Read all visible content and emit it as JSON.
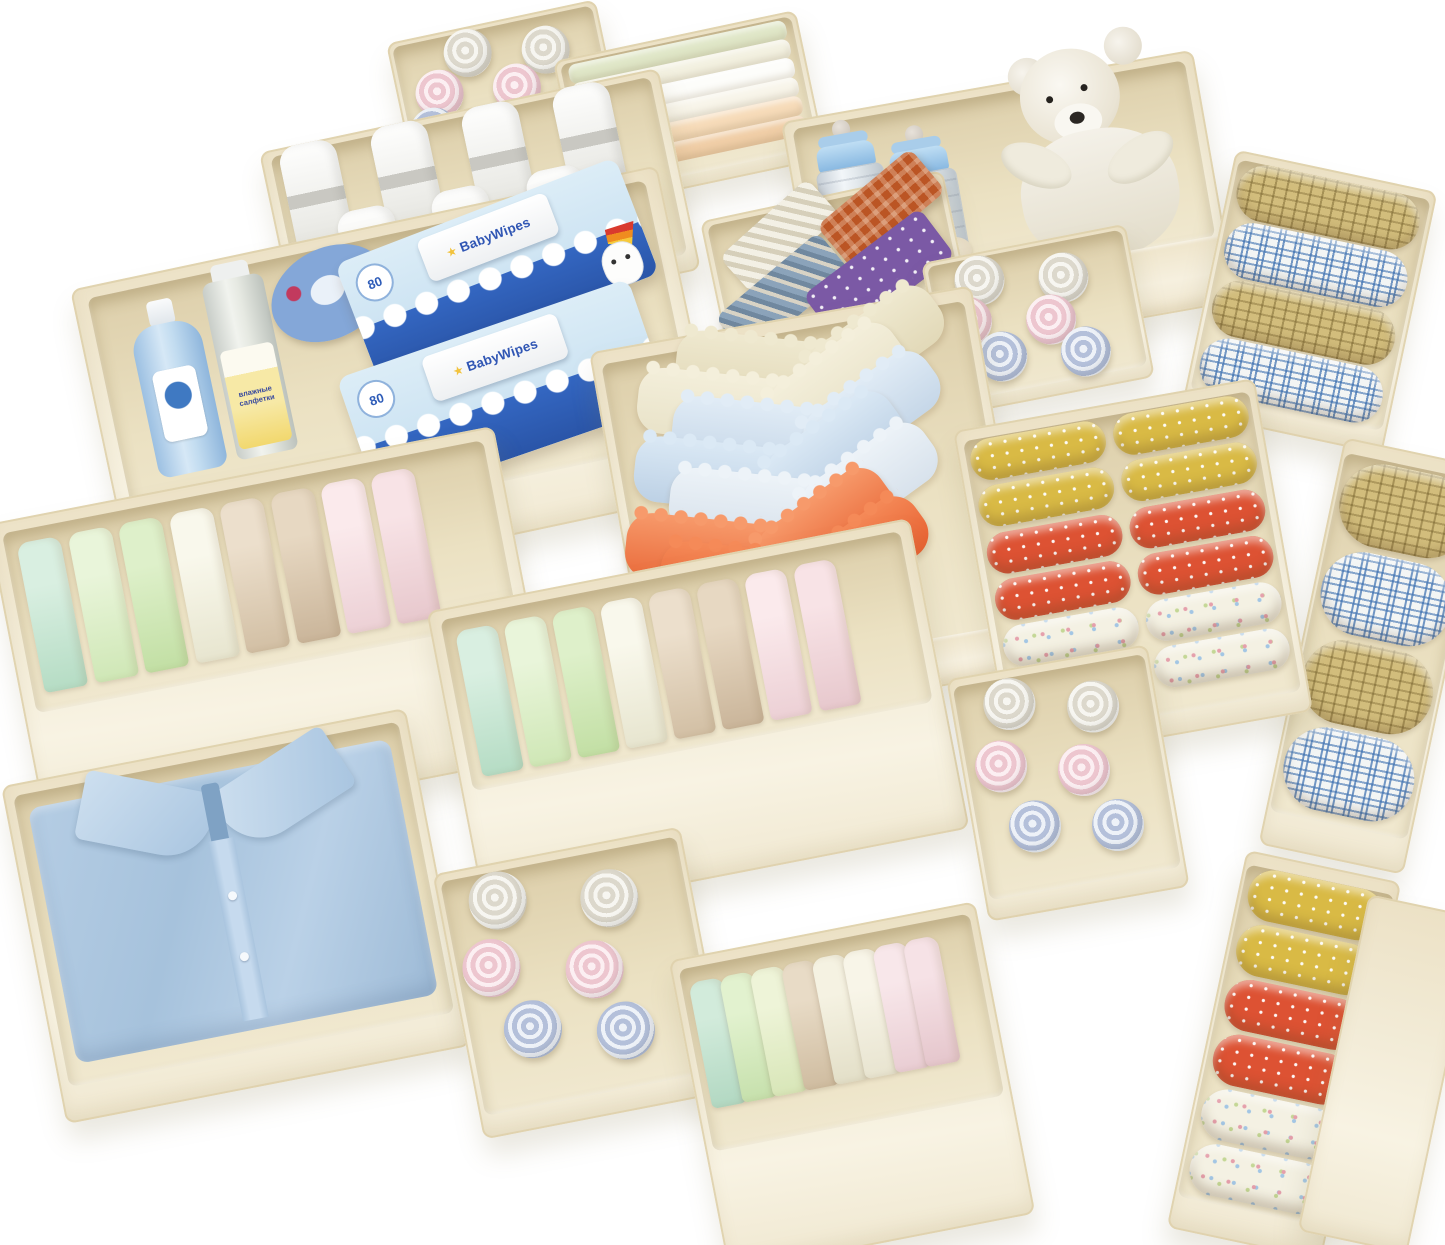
{
  "scene": {
    "type": "product-photo",
    "description": "Set of cream fabric drawer-organizer storage bins photographed at an angle on a white background, filled with baby clothes and nursery items",
    "background_color": "#ffffff",
    "bin_color": "#f2ebd6",
    "bins": [
      {
        "name": "top-rolls-bin",
        "contents": "six rolled baby cloths",
        "colors": [
          "#f7f6f1",
          "#edc6cf",
          "#b4c0da"
        ]
      },
      {
        "name": "folded-stacks-bin",
        "contents": "six folded cloths laid flat",
        "colors": [
          "#e0e7c8",
          "#fdfdfa",
          "#f7dcba"
        ]
      },
      {
        "name": "bottles-and-bear-bin",
        "contents": "two glass baby bottles with blue caps, a pacifier and a white plush teddy bear",
        "colors": [
          "#85b6e0",
          "#f5f2ea"
        ]
      },
      {
        "name": "plaid-rolls-tall-bin",
        "contents": "four rolled plaid cloths, alternating yellow and blue",
        "colors": [
          "#d2bd7c",
          "#3a6eaf"
        ]
      },
      {
        "name": "white-towels-bin",
        "contents": "seven rolled white towels with grey bands",
        "colors": [
          "#fefefd",
          "#c9c8c2"
        ]
      },
      {
        "name": "ties-bin",
        "contents": "four folded neckties: beige stripe, orange check, blue-grey stripe, purple polka dot",
        "colors": [
          "#bb5524",
          "#7b59a5",
          "#8ba3ba"
        ]
      },
      {
        "name": "small-rolls-bin-a",
        "contents": "six rolled baby cloths",
        "colors": [
          "#f7f6f1",
          "#edc6cf",
          "#b4c0da"
        ]
      },
      {
        "name": "baby-care-bin",
        "contents": "blue lotion bottle, wet-wipes canister, blue cream jar and two packs of baby wipes",
        "colors": [
          "#9cc0e2",
          "#2a55a8"
        ]
      },
      {
        "name": "plaid-rolls-side-bin",
        "contents": "four rolled plaid cloths, partially visible at right edge",
        "colors": [
          "#d2bd7c",
          "#3a6eaf"
        ]
      },
      {
        "name": "bras-bin",
        "contents": "seven folded wireless bras with scalloped edges and bow details",
        "colors": [
          "#ea6c3c",
          "#c6d7e8",
          "#e2d9b8"
        ]
      },
      {
        "name": "dotted-rolls-bin",
        "contents": "twelve rolled cloths in two columns: yellow dotted, red dotted and heart print",
        "colors": [
          "#d9ba45",
          "#dd5233",
          "#f4f1e3"
        ]
      },
      {
        "name": "pastel-rolls-bin-left",
        "contents": "eight rolled pastel garments",
        "colors": [
          "#b5dcc4",
          "#cfe7b6",
          "#d2bfa4",
          "#ecd0d5"
        ]
      },
      {
        "name": "pastel-rolls-bin-center",
        "contents": "eight rolled pastel garments",
        "colors": [
          "#b5dcc4",
          "#cfe7b6",
          "#d2bfa4",
          "#ecd0d5"
        ]
      },
      {
        "name": "small-rolls-bin-b",
        "contents": "six rolled baby cloths",
        "colors": [
          "#f7f6f1",
          "#edc6cf",
          "#b4c0da"
        ]
      },
      {
        "name": "rolls-column-bin",
        "contents": "column of six rolled cloths: yellow dotted, red dotted and heart print",
        "colors": [
          "#d9ba45",
          "#dd5233",
          "#f4f1e3"
        ]
      },
      {
        "name": "empty-side-bin",
        "contents": "empty bin, only cream front face visible",
        "colors": [
          "#f2ebd6"
        ]
      },
      {
        "name": "shirt-bin",
        "contents": "folded light-blue button-up shirt",
        "colors": [
          "#a6c2dc"
        ]
      },
      {
        "name": "small-rolls-bin-c",
        "contents": "six rolled baby cloths",
        "colors": [
          "#f7f6f1",
          "#edc6cf",
          "#b4c0da"
        ]
      },
      {
        "name": "pastel-folded-bin",
        "contents": "eight folded pastel garments",
        "colors": [
          "#b2d8c2",
          "#c6e0ac",
          "#cfbca0",
          "#e9cdd3"
        ]
      }
    ]
  },
  "labels": {
    "wipes_brand": "BabyWipes",
    "wipes_count": "80",
    "wipes_star": "★",
    "canister_line1": "влажные",
    "canister_line2": "салфетки"
  }
}
